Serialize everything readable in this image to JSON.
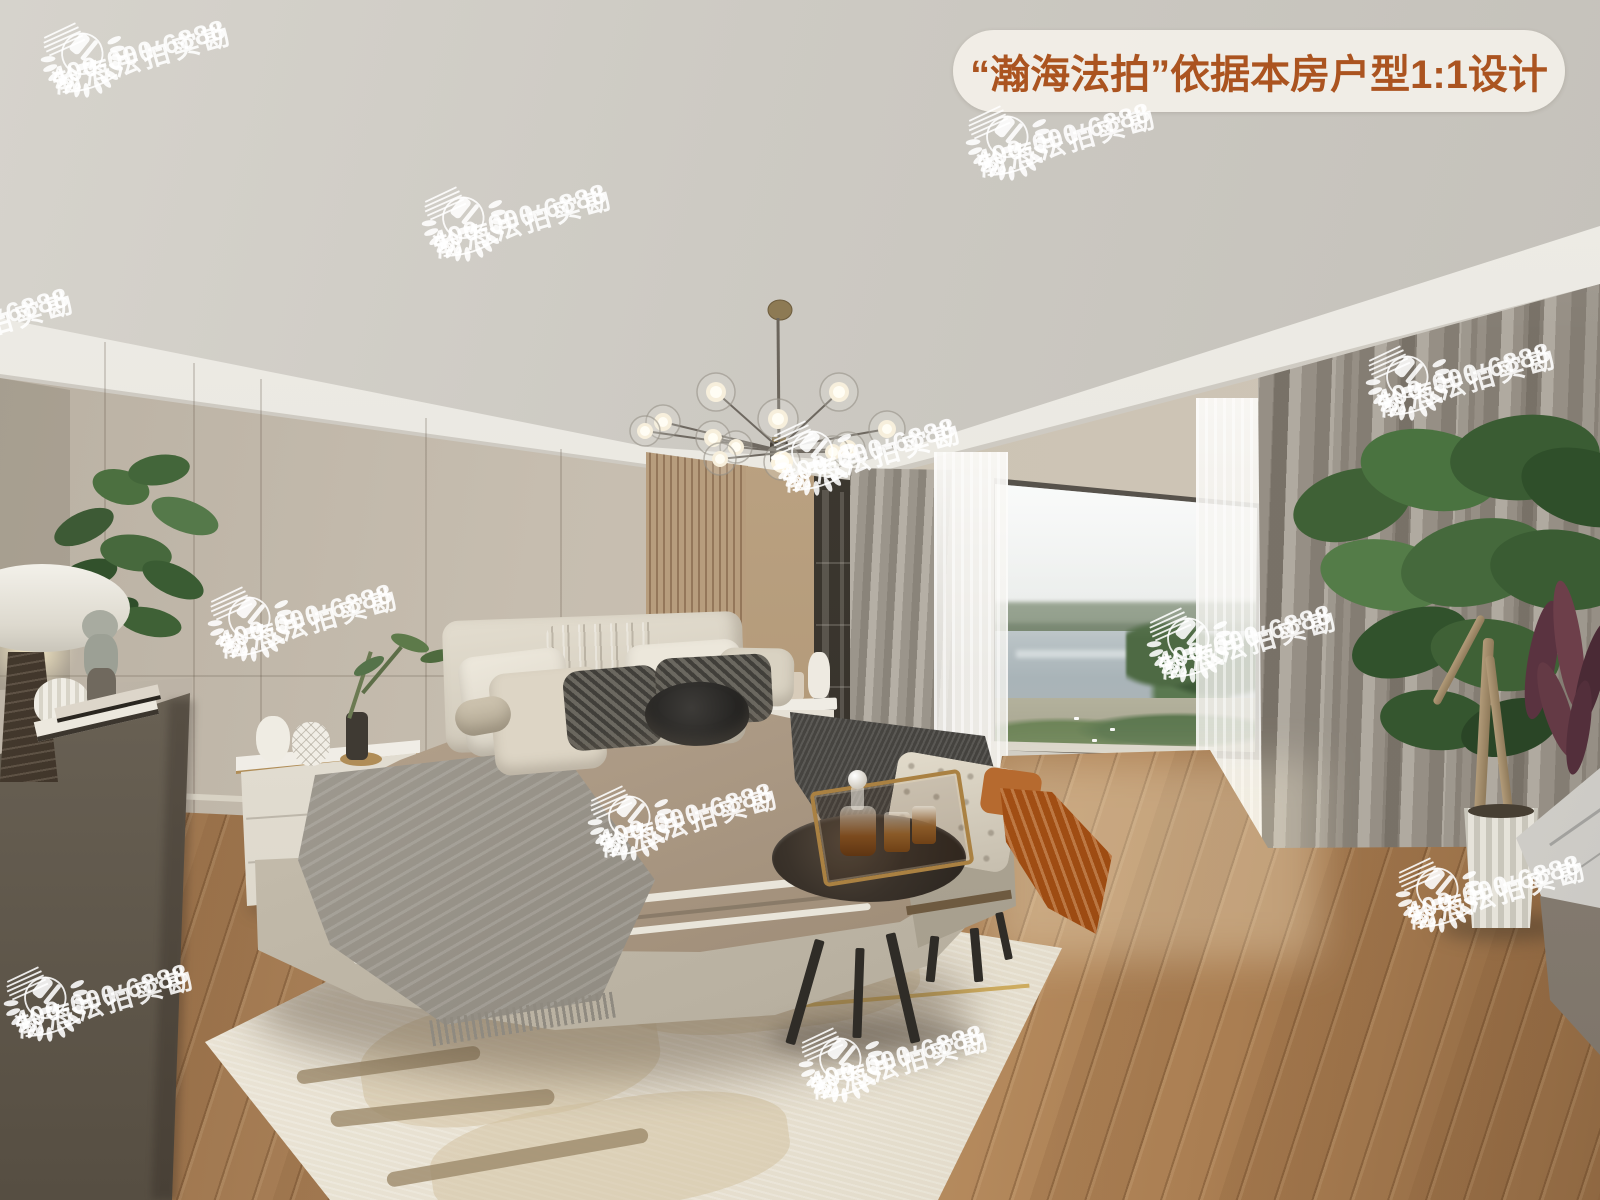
{
  "page": {
    "type": "photograph",
    "subject": "Modern bedroom interior rendering with large lake-view window, double bed, bench, round side table, chandelier and wood floor"
  },
  "badge": {
    "text": "“瀚海法拍”依据本房户型1:1设计",
    "bg_color": "#f2efe8",
    "text_color": "#ab5420"
  },
  "watermark": {
    "brand": "瀚海法拍实勘",
    "phone": "400-000-6888",
    "color": "#ffffff",
    "logo": "laurel-wreath-gavel-emblem",
    "count": 12
  },
  "palette": {
    "ceiling": "#cdcac3",
    "soffit_white": "#e9e7e1",
    "wall_beige": "#c6bdaf",
    "wood_slats": "#b2987a",
    "curtain_gray": "#a39d93",
    "window_lake": "#aeb9bd",
    "floor_wood": "#a9815a",
    "rug_cream": "#e9e3d5",
    "bedding_taupe": "#b4a28d",
    "throw_orange": "#a85316"
  }
}
